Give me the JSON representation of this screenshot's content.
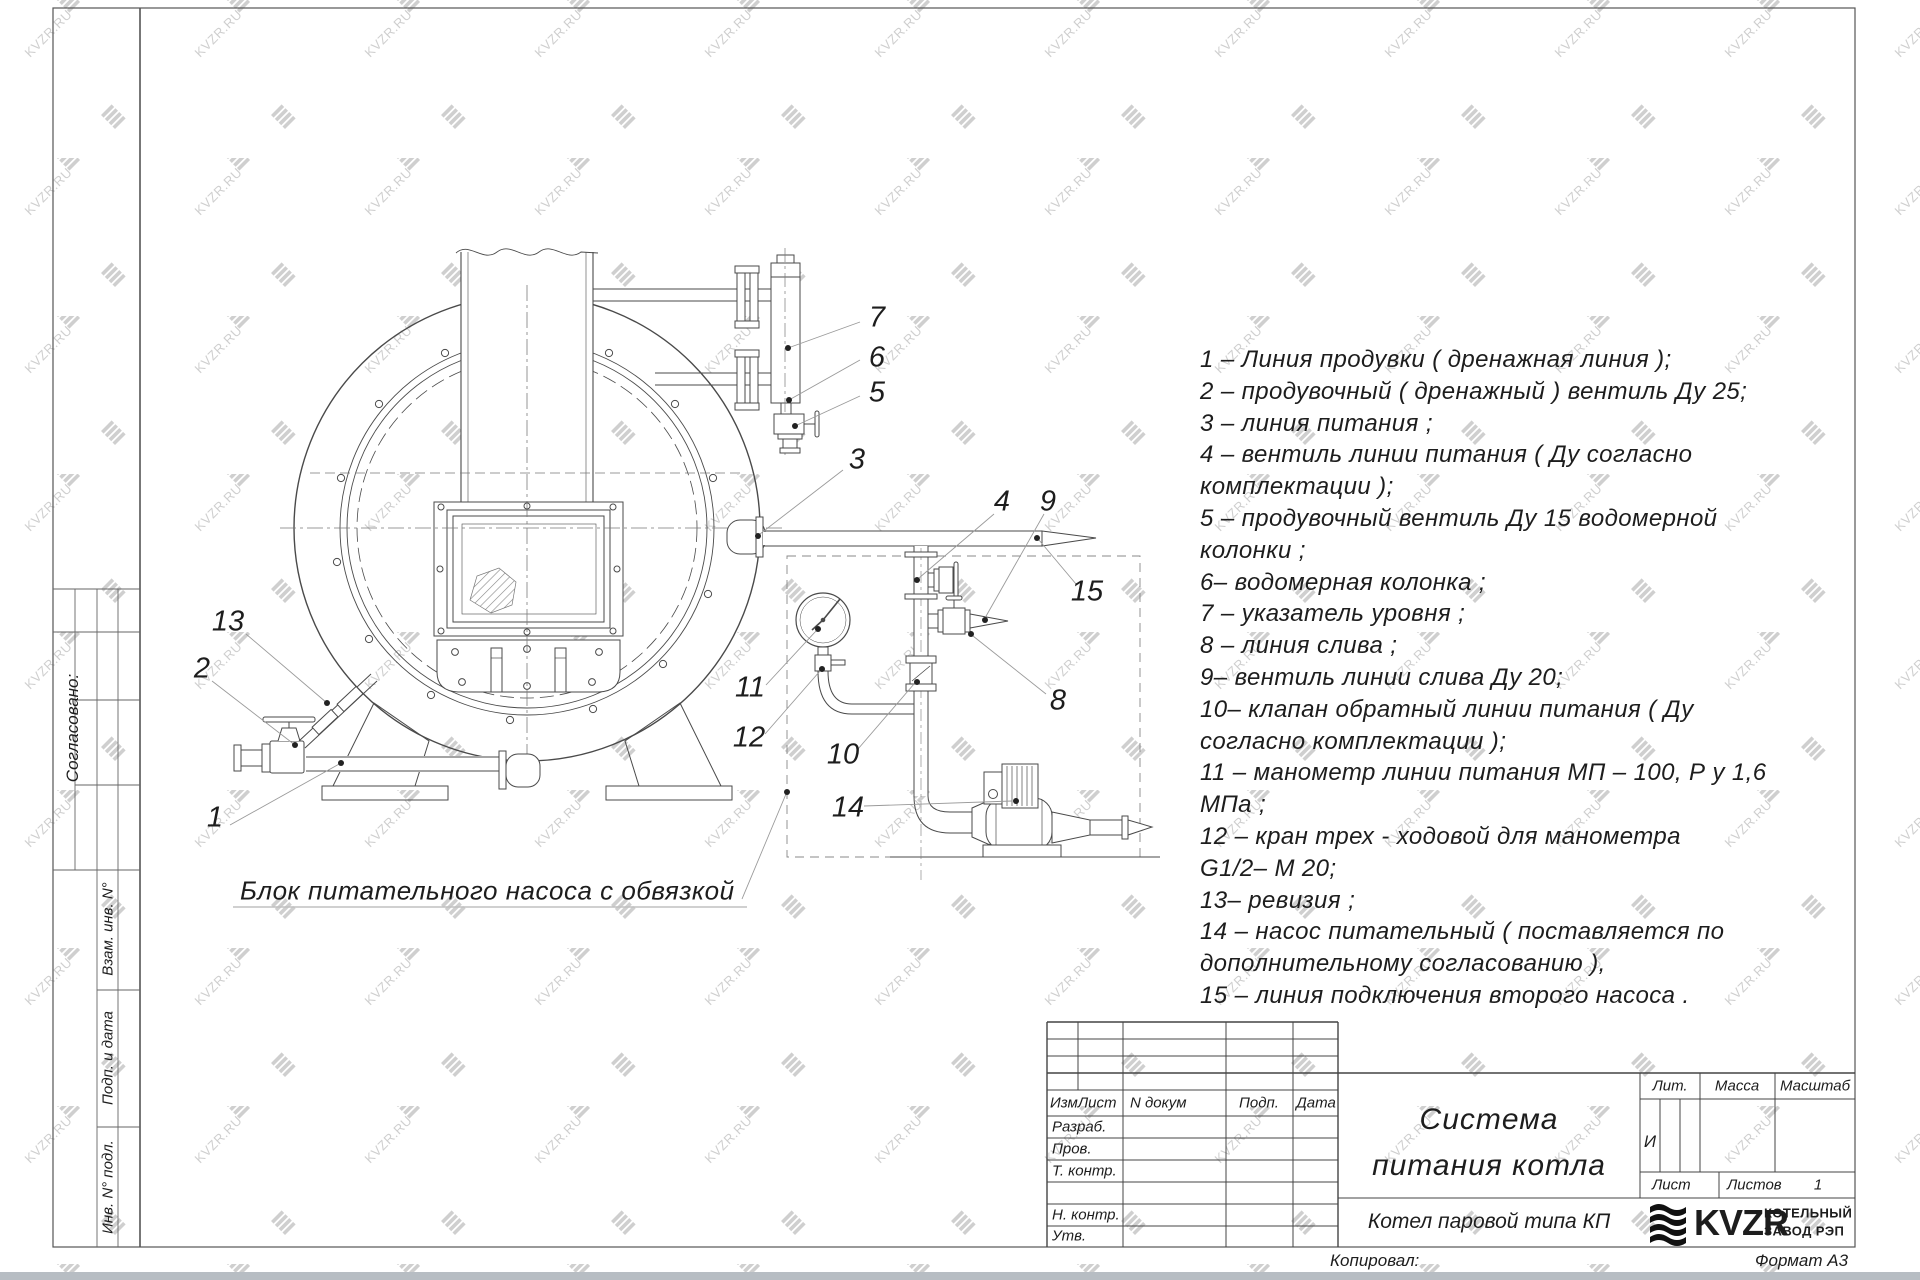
{
  "watermark": {
    "text": "KVZR.RU"
  },
  "drawing": {
    "caption": "Блок питательного насоса с обвязкой",
    "callouts": {
      "c1": "1",
      "c2": "2",
      "c3": "3",
      "c4": "4",
      "c5": "5",
      "c6": "6",
      "c7": "7",
      "c8": "8",
      "c9": "9",
      "c10": "10",
      "c11": "11",
      "c12": "12",
      "c13": "13",
      "c14": "14",
      "c15": "15"
    }
  },
  "legend": {
    "lines": [
      "1 –  Линия продувки  ( дренажная линия );",
      "2 –  продувочный  ( дренажный )  вентиль  Ду 25;",
      "3 –  линия питания ;",
      "4 –  вентиль  линии  питания  ( Ду согласно",
      "комплектации );",
      "5 –  продувочный  вентиль  Ду 15   водомерной",
      "колонки ;",
      "6–  водомерная  колонка ;",
      "7 –  указатель  уровня ;",
      "8 –  линия  слива ;",
      "9–  вентиль  линии  слива  Ду 20;",
      "10–  клапан  обратный  линии  питания  ( Ду",
      "согласно  комплектации );",
      "11 –  манометр  линии  питания  МП – 100,  Р у  1,6",
      "МПа ;",
      "12 –  кран  трех - ходовой  для  манометра",
      "G1/2– М 20;",
      "13–  ревизия ;",
      "14 –  насос  питательный  ( поставляется  по",
      "дополнительному  согласованию ),",
      "15 –  линия  подключения  второго  насоса ."
    ]
  },
  "sidebar": {
    "agreed": "Согласовано:",
    "vzam": "Взам. инв. N°",
    "podp": "Подп. и дата",
    "inv": "Инв. N° подл."
  },
  "titleblock": {
    "rev_izm": "ИзмЛист",
    "rev_doc": "N докум",
    "rev_sign": "Подп.",
    "rev_date": "Дата",
    "row_razrab": "Разраб.",
    "row_prov": "Пров.",
    "row_tkontr": "Т. контр.",
    "row_nkontr": "Н. контр.",
    "row_utv": "Утв.",
    "title_line1": "Система",
    "title_line2": "питания котла",
    "doc_name": "Котел паровой типа КП",
    "lit_label": "Лит.",
    "mass_label": "Масса",
    "scale_label": "Масштаб",
    "lit_value": "И",
    "sheet_label": "Лист",
    "sheets_label": "Листов",
    "sheets_value": "1",
    "brand_name": "KVZR",
    "brand_line1": "КОТЕЛЬНЫЙ",
    "brand_line2": "ЗАВОД РЭП",
    "copied": "Копировал:",
    "format": "Формат А3"
  }
}
